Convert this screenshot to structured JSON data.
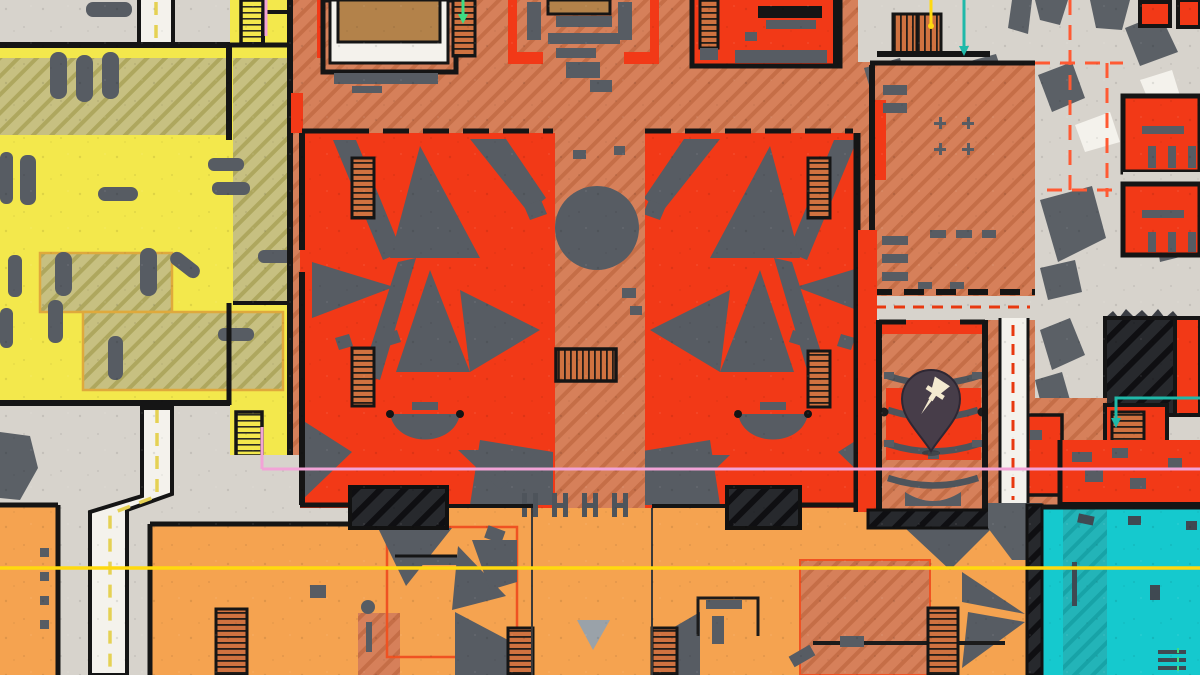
{
  "map": {
    "kind": "top-down floor plan game map",
    "marker": {
      "name": "location-pin",
      "x": 931,
      "y": 451,
      "body_color": "#473d49",
      "glyph": "pushpin",
      "glyph_color": "#f4ead0"
    },
    "palette": {
      "concrete": "#d7d3cc",
      "concrete_white": "#f4f2ec",
      "terra": "#d6805a",
      "terra_line": "#c56e47",
      "khaki": "#c7c081",
      "khaki_line": "#aea75e",
      "yellow": "#f3e84c",
      "red": "#f23917",
      "orange": "#f5a350",
      "tan": "#b3824a",
      "gray_obj": "#575c63",
      "gray_light": "#9aa2a9",
      "rubble": "#5b6066",
      "dark": "#27292d",
      "dark_line": "#0f0f12",
      "wall": "#151515",
      "teal": "#15c9ce",
      "teal_hatch": "#23b4b8",
      "teal_hatch_line": "#17a3a7",
      "stairs": "#cf7240",
      "line_yellow": "#ffd90f",
      "dash_yellow": "#e5d154",
      "pink": "#f2a3d7",
      "dash_orange": "#ff5a33",
      "dash_red": "#e8380f",
      "teal_line": "#1fb9a9",
      "green": "#3ddc84",
      "pin_body": "#473d49",
      "pin_glyph": "#f4ead0"
    },
    "route_lines": {
      "yellow_zipline": {
        "y": 568,
        "x1": 0,
        "x2": 1200,
        "color": "#ffd90f"
      },
      "pink_zipline": {
        "y": 469,
        "x1": 262,
        "x2": 1200,
        "color": "#f2a3d7"
      }
    },
    "drop_lines": {
      "green_entry_north": {
        "x": 463,
        "y1": 0,
        "y2": 16,
        "color": "#3ddc84"
      },
      "yellow_entry_north": {
        "x": 931,
        "y1": 0,
        "y2": 24,
        "color": "#ffd90f"
      },
      "teal_entry_north": {
        "x": 964,
        "y1": 0,
        "y2": 48,
        "color": "#1fb9a9"
      },
      "pink_entry_north": {
        "x": 266,
        "y1": 0,
        "y2": 36,
        "color": "#f2a3d7"
      }
    },
    "zones": [
      {
        "id": "yellow-rooms-west",
        "color_key": "yellow"
      },
      {
        "id": "khaki-hatched-subrooms",
        "color_key": "khaki"
      },
      {
        "id": "terracotta-concourse",
        "color_key": "terra"
      },
      {
        "id": "red-hall-west",
        "color_key": "red"
      },
      {
        "id": "red-hall-east",
        "color_key": "red"
      },
      {
        "id": "theater-room",
        "color_key": "terra"
      },
      {
        "id": "orange-hall-south",
        "color_key": "orange"
      },
      {
        "id": "teal-room-southeast",
        "color_key": "teal"
      },
      {
        "id": "concrete-courtyards",
        "color_key": "concrete"
      }
    ]
  }
}
